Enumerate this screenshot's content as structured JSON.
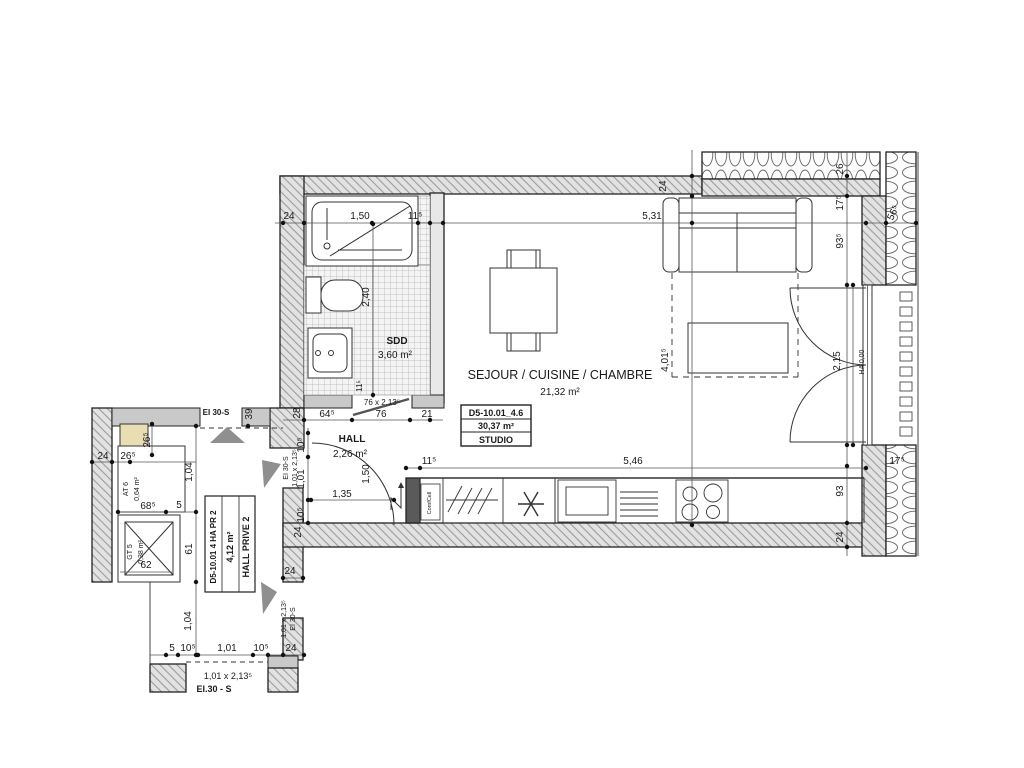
{
  "plan": {
    "unit_box": {
      "code": "D5-10.01_4.6",
      "area": "30,37 m²",
      "type": "STUDIO"
    },
    "rooms": {
      "main": {
        "name": "SEJOUR / CUISINE / CHAMBRE",
        "area": "21,32 m²"
      },
      "bathroom": {
        "name": "SDD",
        "area": "3,60 m²"
      },
      "hall": {
        "name": "HALL",
        "area": "2,26 m²"
      },
      "corridor": {
        "code": "D5-10.01 4 HA PR 2",
        "area": "4,12 m²",
        "name": "HALL PRIVE 2"
      },
      "shaft_at": {
        "name": "AT 6",
        "area": "0,64 m²"
      },
      "shaft_gt": {
        "name": "GT 5",
        "area": "0,38 m²"
      }
    },
    "doors": {
      "bath_door": "76 x 2,13⁵",
      "corridor_top_label": "EI 30-S",
      "entry_door_size": "1,01 x 2,13⁵",
      "entry_door_label": "EI 30-S",
      "lower_door_size": "1,01 x 2,13⁵",
      "lower_door_label": "EI 30-S",
      "bottom_door_size": "1,01 x 2,13⁵",
      "bottom_door_label": "EI.30 - S",
      "threshold": "HA 0,00"
    },
    "appliances": {
      "vent_unit": "ComfCell"
    },
    "dims": {
      "top24": "24",
      "bath150": "1,50",
      "top115": "11⁵",
      "main531": "5,31",
      "wall24v": "24",
      "r26": "26",
      "r175": "17⁵",
      "r935": "93⁵",
      "r565": "56⁵",
      "bath240": "2,40",
      "bath115v": "11⁵",
      "b28": "28",
      "b645": "64⁵",
      "b76": "76",
      "b21": "21",
      "h105a": "10⁵",
      "h101": "1,01",
      "h105b": "10⁵",
      "h150": "1,50",
      "h135": "1,35",
      "k115": "11⁵",
      "k546": "5,46",
      "m4015": "4,01⁵",
      "m215": "2,15",
      "r93": "93",
      "r24": "24",
      "r175b": "17⁵",
      "w24a": "24",
      "w24b": "24",
      "c39": "39",
      "l24": "24",
      "l265a": "26⁵",
      "l265b": "26⁵",
      "l104a": "1,04",
      "l685": "68⁵",
      "l5": "5",
      "l62": "62",
      "l61": "61",
      "l104b": "1,04",
      "bl5": "5",
      "bl105a": "10⁵",
      "bl101": "1,01",
      "bl105b": "10⁵",
      "bl24": "24"
    }
  }
}
